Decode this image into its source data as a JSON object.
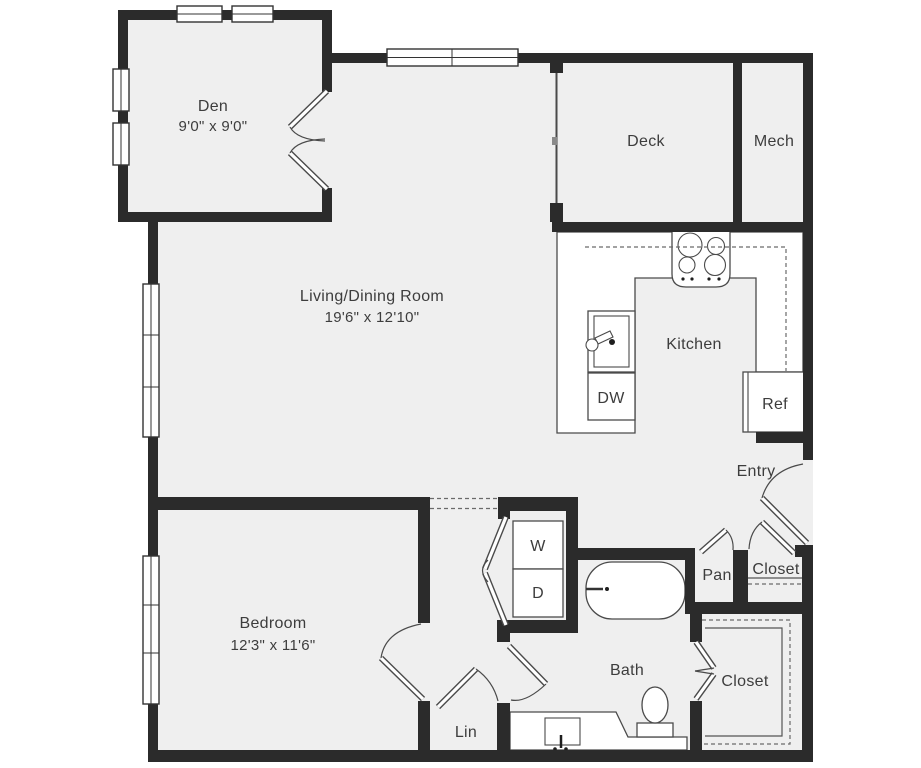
{
  "title": "Apartment Floor Plan",
  "palette": {
    "wall": "#2b2b2b",
    "floor": "#efefef",
    "line": "#4a4a4a",
    "text": "#3d3d3d",
    "background": "#ffffff"
  },
  "rooms": {
    "den": {
      "label": "Den",
      "dims": "9'0\" x 9'0\""
    },
    "living": {
      "label": "Living/Dining Room",
      "dims": "19'6\" x 12'10\""
    },
    "deck": {
      "label": "Deck"
    },
    "mech": {
      "label": "Mech"
    },
    "kitchen": {
      "label": "Kitchen"
    },
    "entry": {
      "label": "Entry"
    },
    "bedroom": {
      "label": "Bedroom",
      "dims": "12'3\" x 11'6\""
    },
    "bath": {
      "label": "Bath"
    },
    "pantry": {
      "label": "Pan"
    },
    "entry_closet": {
      "label": "Closet"
    },
    "walkin_closet": {
      "label": "Closet"
    },
    "linen": {
      "label": "Lin"
    }
  },
  "fixtures": {
    "washer": "W",
    "dryer": "D",
    "dishwasher": "DW",
    "refrigerator": "Ref"
  }
}
